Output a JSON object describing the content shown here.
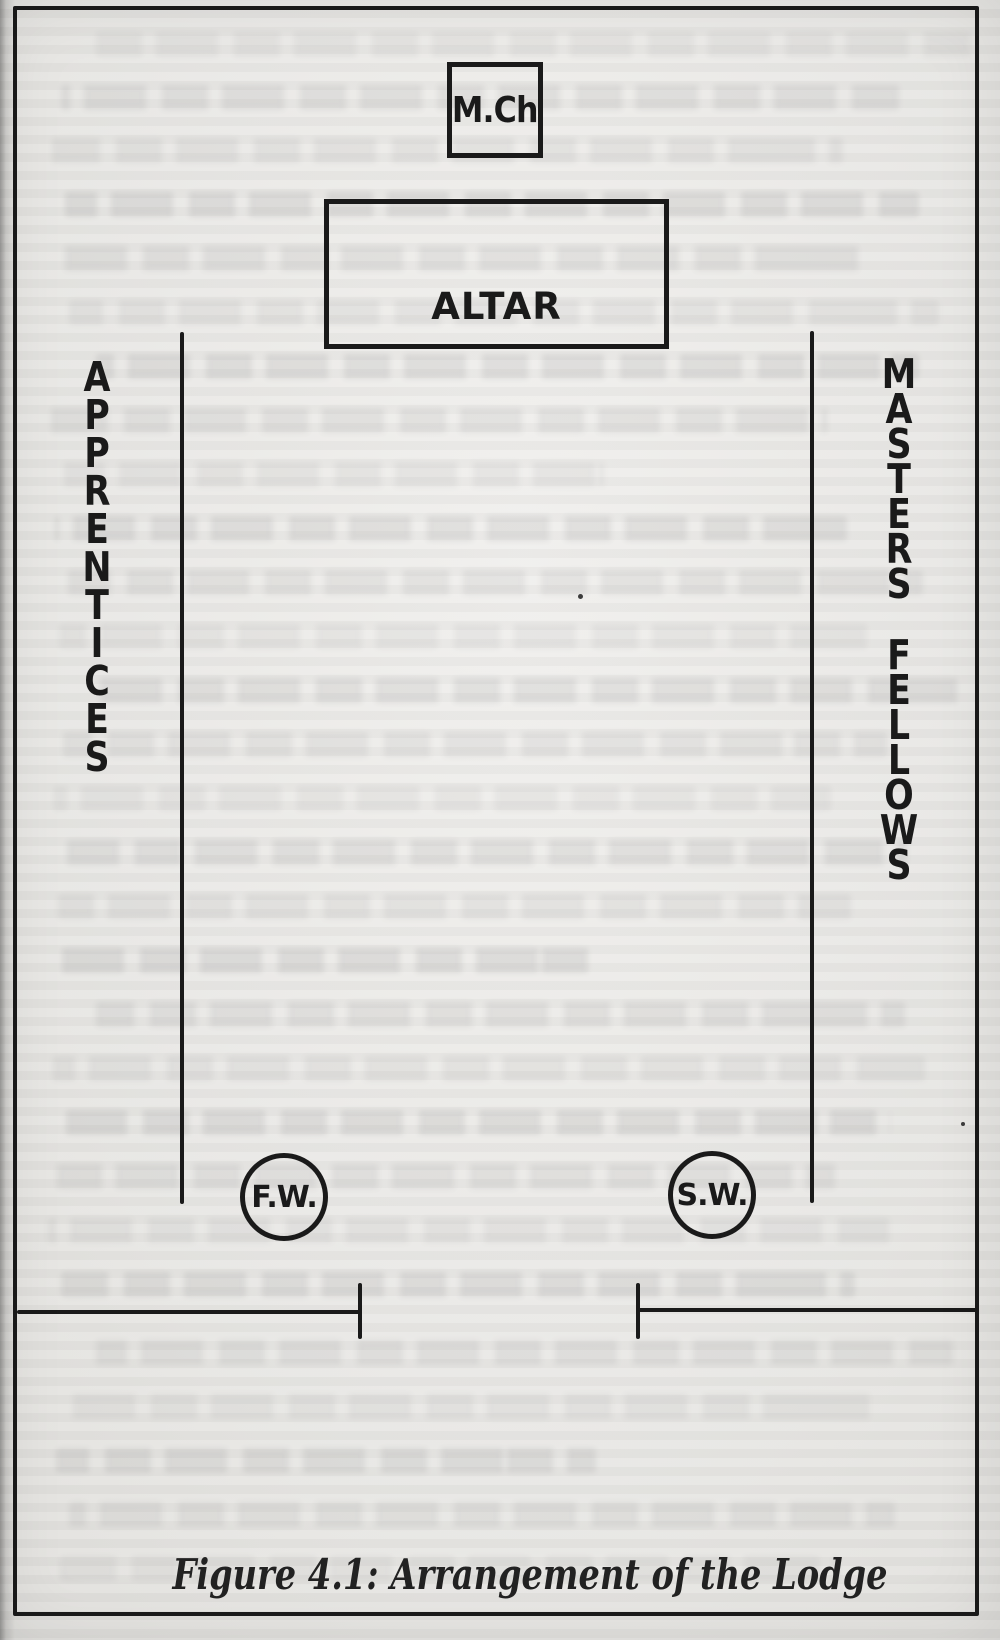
{
  "figure": {
    "caption": "Figure 4.1: Arrangement of the Lodge",
    "master_chair_label": "M.Ch",
    "altar_label": "ALTAR",
    "left_column_label": "APPRENTICES",
    "right_column_word1": "MASTERS",
    "right_column_word2": "FELLOWS",
    "circle_left_label": "F.W.",
    "circle_right_label": "S.W.",
    "colors": {
      "ink": "#1a1a1a",
      "paper": "#e8e7e4"
    }
  }
}
